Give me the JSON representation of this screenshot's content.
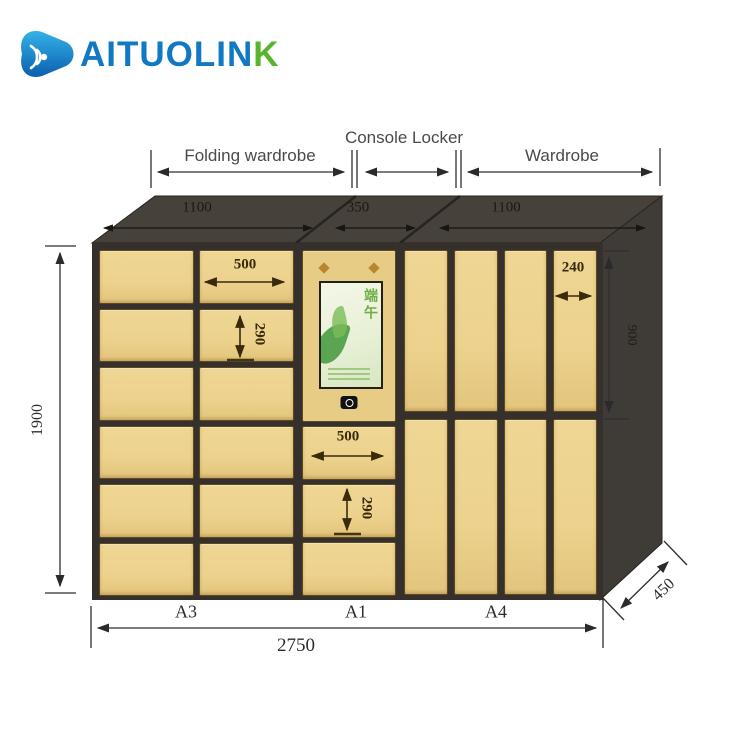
{
  "brand": {
    "text_blue": "AITUOLIN",
    "text_green": "K"
  },
  "header": {
    "labels": {
      "left": "Folding wardrobe",
      "middle": "Console Locker",
      "right": "Wardrobe"
    }
  },
  "top_widths": {
    "left": "1100",
    "middle": "350",
    "right": "1100"
  },
  "overall_dims": {
    "height": "1900",
    "width": "2750",
    "depth": "450",
    "right_column_height": "900"
  },
  "door_dims": {
    "a3_width": "500",
    "a3_height": "290",
    "a1_width": "500",
    "a1_height": "290",
    "a4_width": "240"
  },
  "bottom_labels": {
    "left": "A3",
    "middle": "A1",
    "right": "A4"
  },
  "console": {
    "poster_text": "端午"
  },
  "colors": {
    "door": "#ecd28d",
    "cabinet_front": "#35302b",
    "brand_blue": "#1178c4",
    "brand_green": "#58b52f"
  }
}
